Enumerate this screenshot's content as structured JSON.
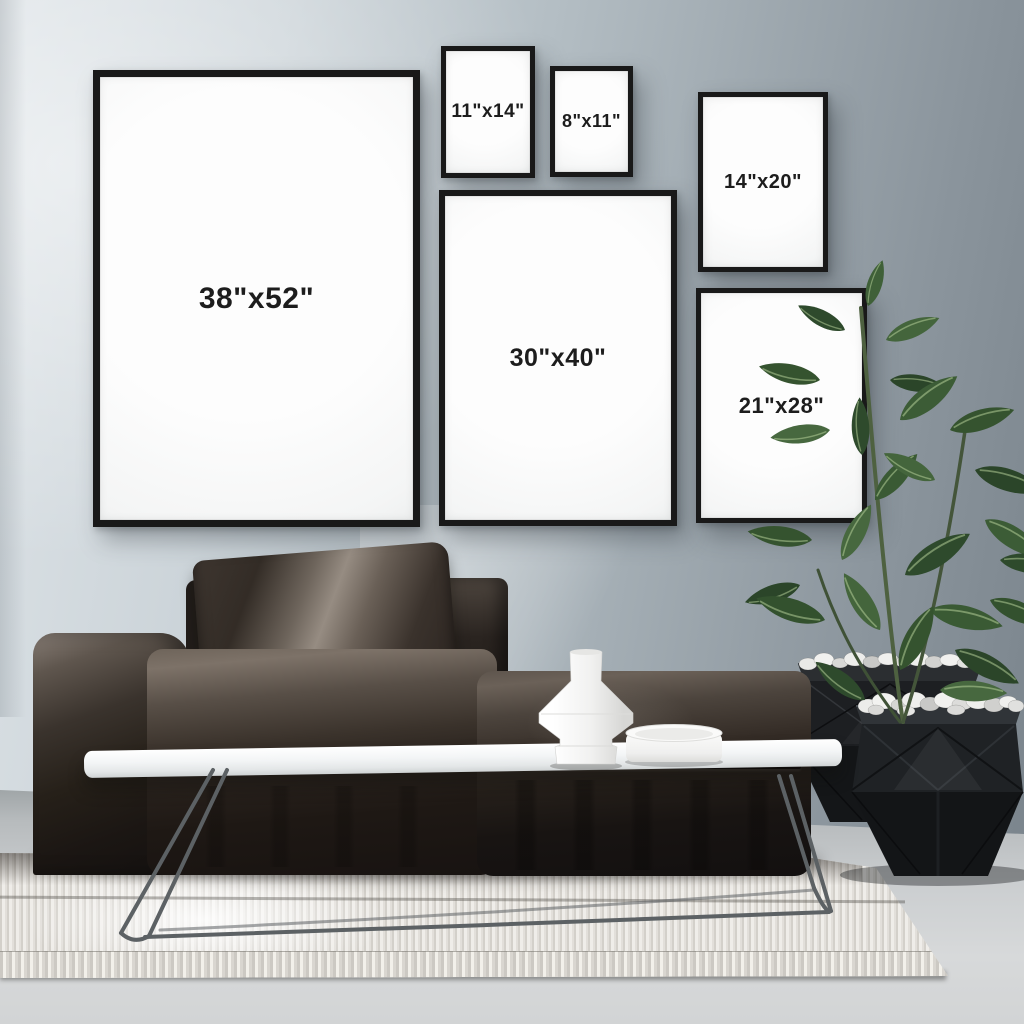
{
  "scene": {
    "description": "Living-room gallery wall poster size guide mockup",
    "frames": [
      {
        "name": "frame-38x52",
        "label": "38\"x52\""
      },
      {
        "name": "frame-11x14",
        "label": "11\"x14\""
      },
      {
        "name": "frame-8x11",
        "label": "8\"x11\""
      },
      {
        "name": "frame-14x20",
        "label": "14\"x20\""
      },
      {
        "name": "frame-30x40",
        "label": "30\"x40\""
      },
      {
        "name": "frame-21x28",
        "label": "21\"x28\""
      }
    ],
    "objects": [
      "dark-modular-sofa",
      "sofa-pillow",
      "white-coffee-table",
      "geometric-white-vase",
      "white-bowl",
      "black-faceted-planters",
      "white-pebbles",
      "rubber-plant",
      "ribbed-white-rug",
      "concrete-floor",
      "grey-blue-wall"
    ],
    "palette": {
      "wall_light": "#dde3e7",
      "wall_dark": "#79838b",
      "frame_black": "#191919",
      "canvas_white": "#f8f9f9",
      "label_text": "#1d1d1d",
      "sofa_dark": "#241f1c",
      "sofa_highlight": "#968c82",
      "table_white": "#f3f5f6",
      "rug_offwhite": "#e9e7e2",
      "floor_grey": "#cbced0",
      "leaf_green": "#3a5a36",
      "planter_black": "#16181a"
    }
  }
}
